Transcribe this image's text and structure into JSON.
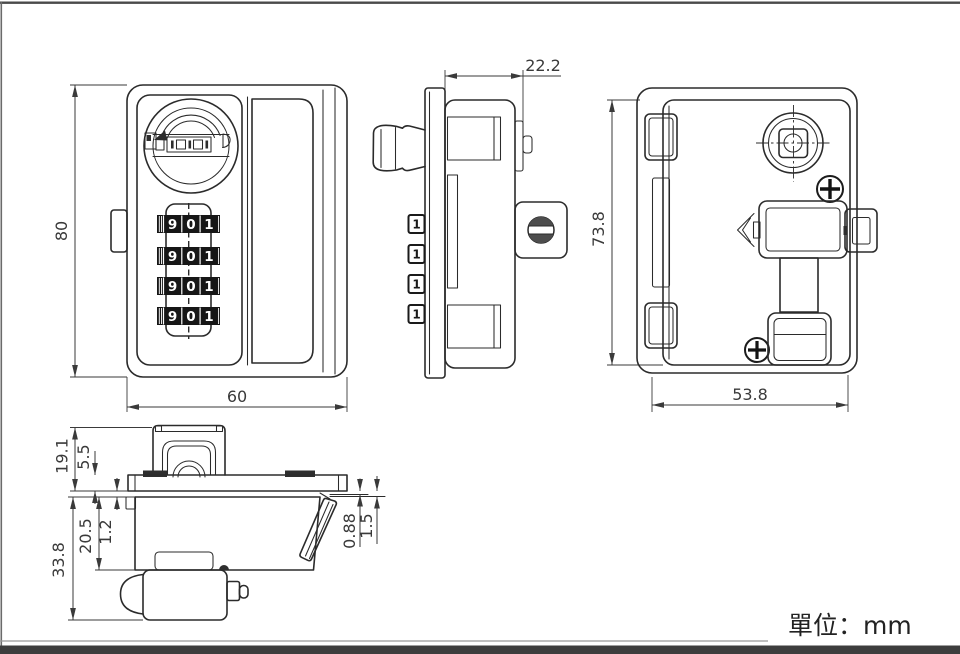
{
  "page": {
    "unit_label": "單位：mm",
    "background": "#ffffff",
    "line_color": "#2b2b2b",
    "dim_color": "#3a3a3a"
  },
  "views": {
    "front": {
      "label": "front view of combination cam lock",
      "dim_height": "80",
      "dim_width": "60",
      "dial_digits": [
        "9",
        "0",
        "1"
      ],
      "dial_rows": 4
    },
    "side": {
      "label": "side view",
      "dim_depth": "22.2",
      "wheel_digit": "1"
    },
    "back": {
      "label": "back view",
      "dim_height": "73.8",
      "dim_width": "53.8"
    },
    "top": {
      "label": "top profile view",
      "dim_knob_height": "19.1",
      "dim_cap_height": "5.5",
      "dim_total_height": "33.8",
      "dim_body_height": "20.5",
      "dim_offset": "1.2",
      "dim_lip_a": "0.88",
      "dim_lip_b": "1.5"
    }
  }
}
